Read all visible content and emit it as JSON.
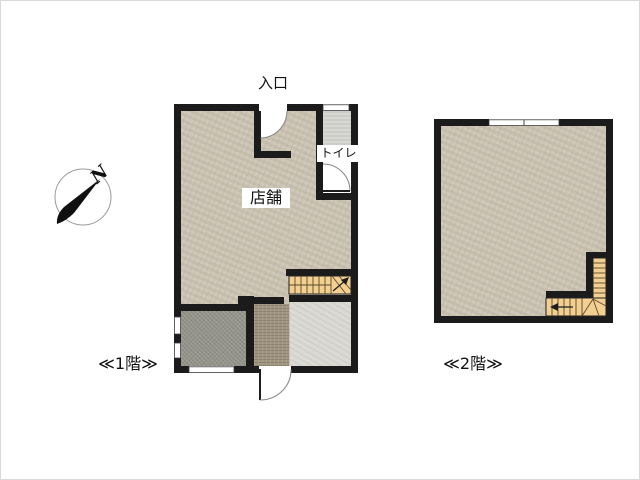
{
  "compass": {
    "north_label": "N"
  },
  "floors": {
    "floor1": {
      "caption": "≪1階≫",
      "entrance_label": "入口",
      "shop_label": "店舗",
      "toilet_label": "トイレ"
    },
    "floor2": {
      "caption": "≪2階≫"
    }
  },
  "colors": {
    "wall": "#1b1b1b",
    "floor_main": "#cdc5b5",
    "toilet_floor": "#d7d7d4",
    "room_gray": "#98978e",
    "strip_brown": "#9f9580",
    "room_light": "#dbdad5",
    "stairs": "#f3cf92",
    "label_text": "#111111"
  }
}
